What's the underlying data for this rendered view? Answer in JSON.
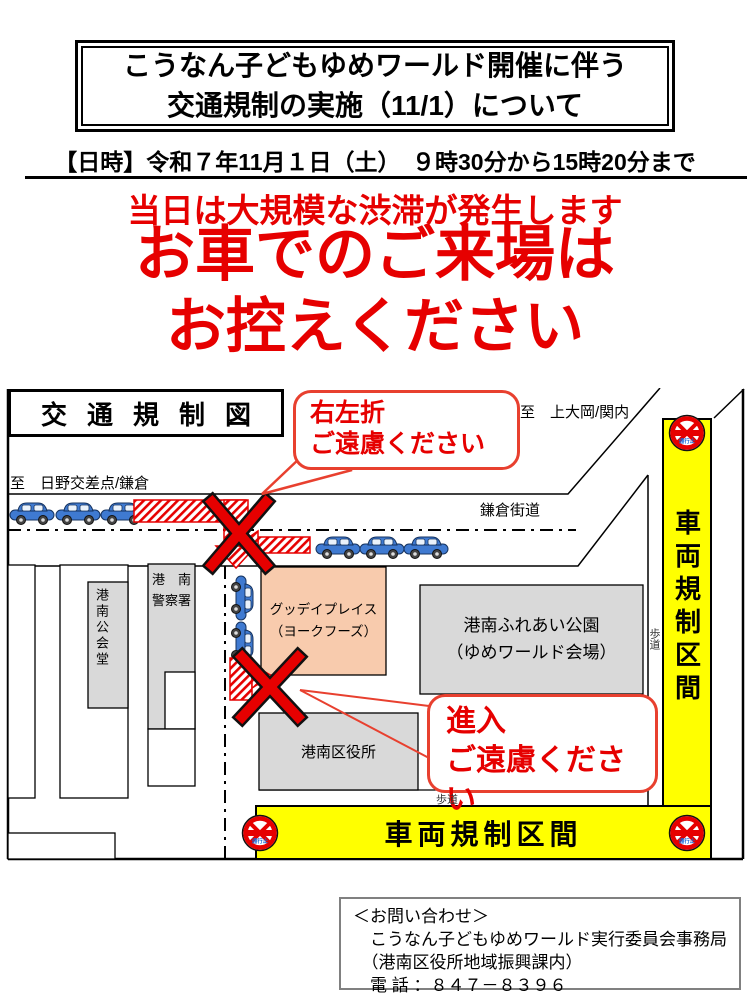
{
  "header": {
    "title_line1": "こうなん子どもゆめワールド開催に伴う",
    "title_line2": "交通規制の実施（11/1）について",
    "datetime": "【日時】令和７年11月１日（土）　９時30分から15時20分まで",
    "warning_line1": "当日は大規模な渋滞が発生します",
    "warning_line2": "お車でのご来場は",
    "warning_line3": "お控えください"
  },
  "map": {
    "title": "交通規制図",
    "callout_no_turn": {
      "line1": "右左折",
      "line2": "ご遠慮ください"
    },
    "callout_no_entry": {
      "line1": "進入",
      "line2": "ご遠慮ください"
    },
    "dest_northeast": "至　上大岡/関内",
    "dest_west": "至　日野交差点/鎌倉",
    "road_name": "鎌倉街道",
    "buildings": {
      "public_hall": "港南公会堂",
      "police_line1": "港　南",
      "police_line2": "警察署",
      "gooday_line1": "グッデイプレイス",
      "gooday_line2": "（ヨークフーズ）",
      "park_line1": "港南ふれあい公園",
      "park_line2": "（ゆめワールド会場）",
      "ward_office": "港南区役所"
    },
    "sidewalk_right": "歩道",
    "sidewalk_bottom": "歩道",
    "zone_right": "車両規制区間",
    "zone_bottom": "車両規制区間",
    "no_entry_sign_label": "通行止"
  },
  "contact": {
    "line1": "＜お問い合わせ＞",
    "line2": "　こうなん子どもゆめワールド実行委員会事務局",
    "line3": "　（港南区役所地域振興課内）",
    "line4": "　電 話 ：８４７－８３９６"
  },
  "colors": {
    "warning_red": "#e60000",
    "callout_red": "#e8402f",
    "zone_yellow": "#ffff00",
    "building_gray": "#d9d9d9",
    "gooday_peach": "#f8cbad",
    "car_blue": "#3f7ad1",
    "sign_label_blue": "#1565d8"
  }
}
